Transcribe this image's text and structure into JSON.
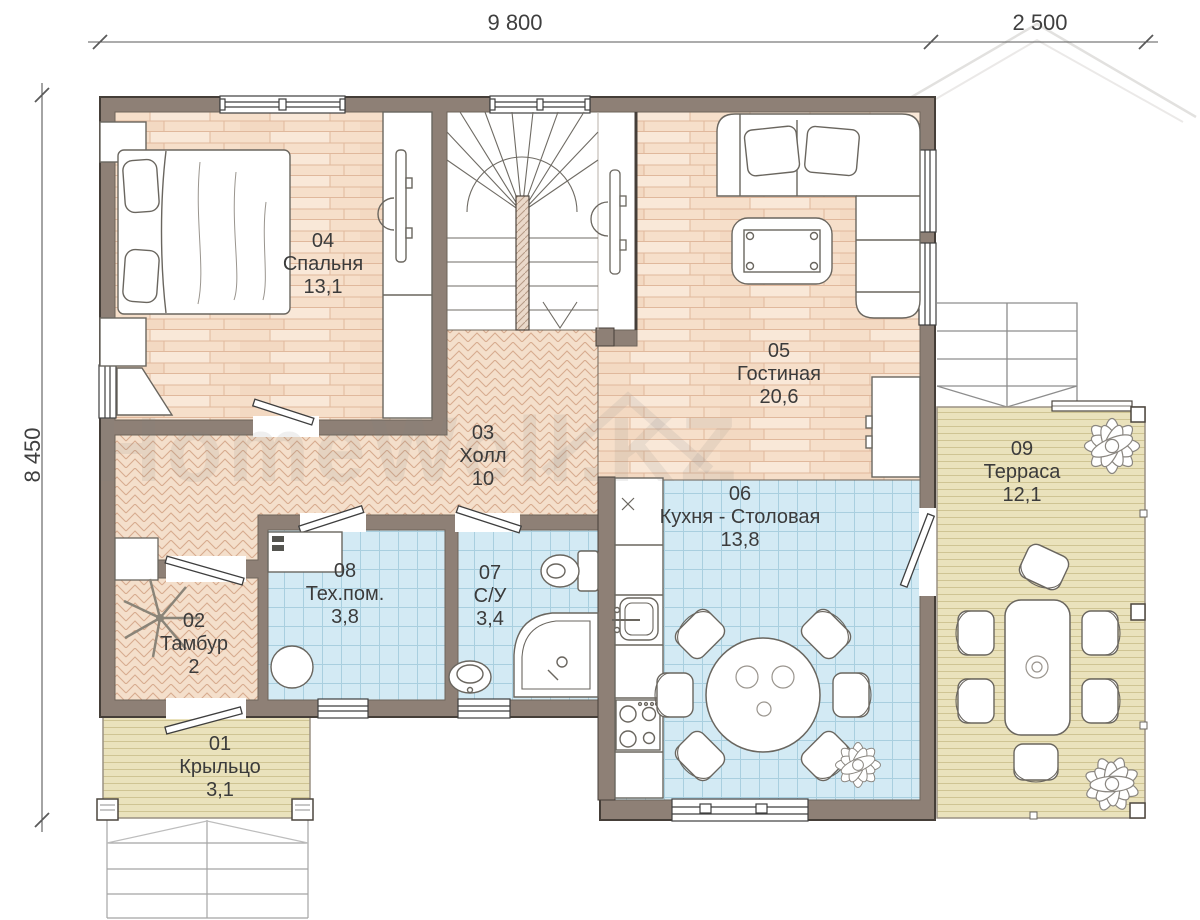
{
  "plan_title": "Floor plan – first floor",
  "dimensions": {
    "width_main": "9 800",
    "width_terrace": "2 500",
    "height": "8 450"
  },
  "watermark": "HomeWell.KZ",
  "rooms": [
    {
      "num": "01",
      "name": "Крыльцо",
      "area": "3,1"
    },
    {
      "num": "02",
      "name": "Тамбур",
      "area": "2"
    },
    {
      "num": "03",
      "name": "Холл",
      "area": "10"
    },
    {
      "num": "04",
      "name": "Спальня",
      "area": "13,1"
    },
    {
      "num": "05",
      "name": "Гостиная",
      "area": "20,6"
    },
    {
      "num": "06",
      "name": "Кухня - Столовая",
      "area": "13,8"
    },
    {
      "num": "07",
      "name": "С/У",
      "area": "3,4"
    },
    {
      "num": "08",
      "name": "Тех.пом.",
      "area": "3,8"
    },
    {
      "num": "09",
      "name": "Терраса",
      "area": "12,1"
    }
  ],
  "colors": {
    "wall": "#8e8076",
    "wood_floor": "#f6dfca",
    "parquet_floor": "#f4dfcb",
    "tile_floor": "#d3eaf4",
    "deck_floor": "#eae2bc"
  }
}
